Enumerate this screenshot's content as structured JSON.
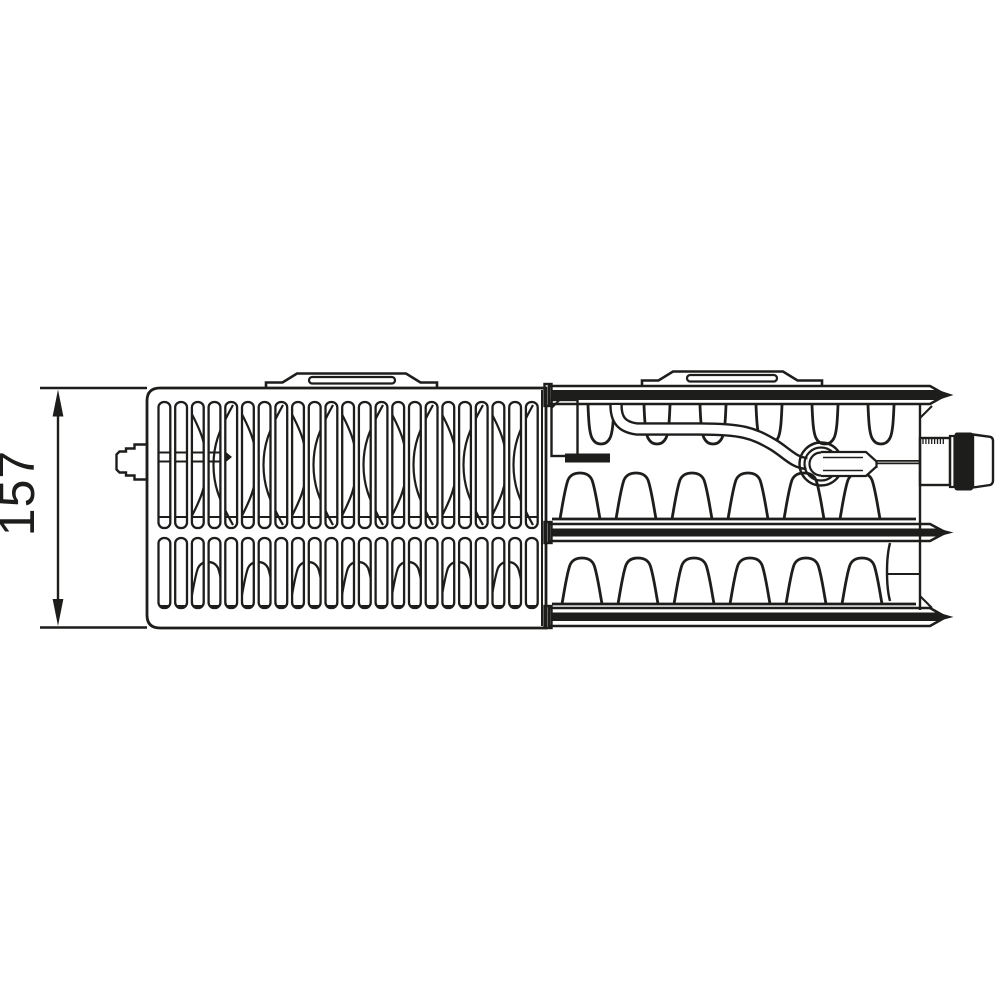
{
  "page": {
    "background_color": "#ffffff",
    "line_color": "#1d1d1b"
  },
  "diagram": {
    "type": "technical-line-drawing",
    "subject": "panel-radiator-top-view-with-cutaway",
    "dimension": {
      "label": "157"
    }
  }
}
